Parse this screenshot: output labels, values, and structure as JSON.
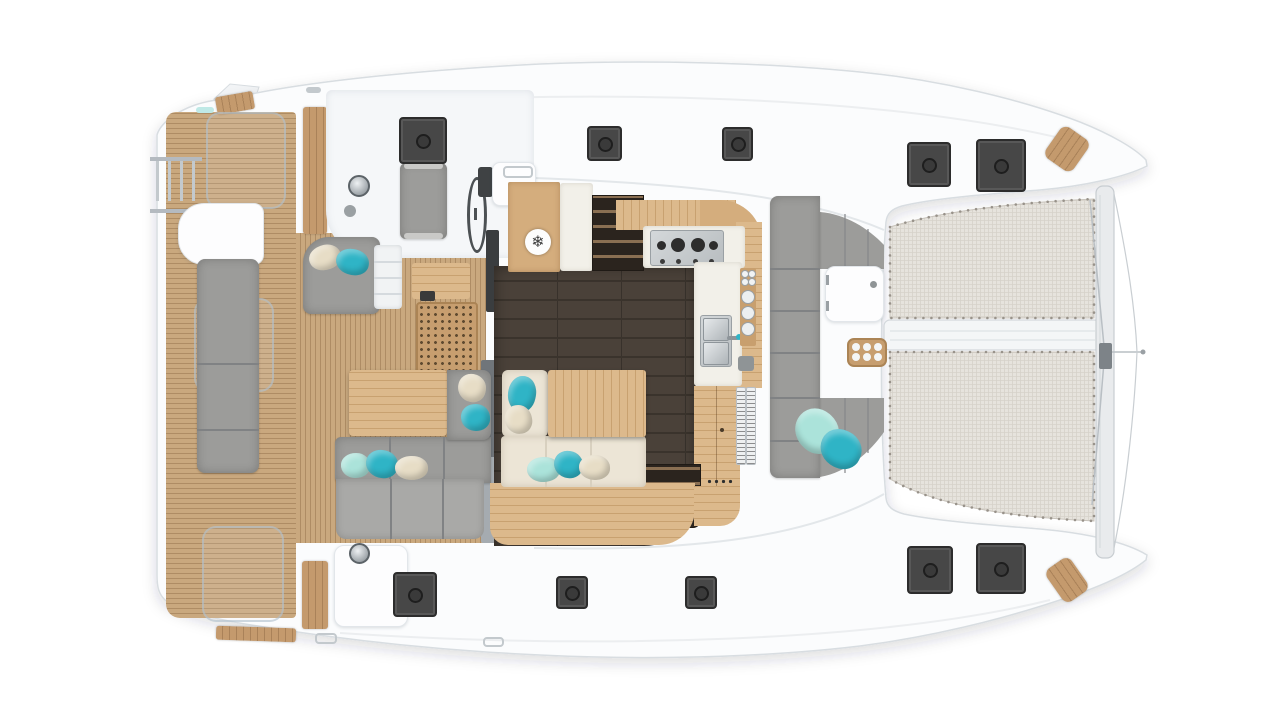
{
  "scene": {
    "subject": "Catamaran yacht deck floor plan, top-down 3D render",
    "view": "top-down",
    "background": "#ffffff"
  },
  "colors": {
    "page_bg": "#ffffff",
    "hull_white": "#fbfcfd",
    "deck_white": "#f5f7f9",
    "outline_gray": "#d8dde1",
    "teak": "#c9a87e",
    "teak_stripe": "#ae8c64",
    "plank_wood": "#c49a6d",
    "galley_wood": "#d4ad7d",
    "table_wood": "#dcb98c",
    "table_wood_line": "#c8a170",
    "saloon_floor": "#4a4139",
    "floor_line": "#3a332c",
    "counter_white": "#f2f0e9",
    "cushion_gray": "#9c9c9a",
    "cushion_gray_light": "#a9a9a7",
    "seam": "#808284",
    "cream_cushion": "#ece5d6",
    "pillow_teal": "#2fb4c6",
    "pillow_mint": "#abe3da",
    "pillow_cream": "#e7ddc6",
    "hatch": "#474747",
    "hatch_dark": "#2c2c2c",
    "hatch_mid": "#585858",
    "mesh": "#e6e3dd",
    "mesh_line": "#d6d2ca",
    "mesh_dot": "#98928a",
    "beam": "#e9ebed",
    "beam_border": "#c8cdd1",
    "grate": "#c79e6f",
    "grate_dot": "#5f4a30",
    "louver_white": "#eef0f1",
    "step_dark": "#2b241e",
    "step_wood": "#8a6f52"
  },
  "icons": {
    "snowflake": "❄"
  },
  "regions": [
    "swim platform and boarding ladder",
    "aft cockpit with sofa and table",
    "helm station with wheel",
    "saloon with galley and settee",
    "forward cockpit lounge",
    "twin trampolines",
    "bow crossbeam"
  ],
  "equipment": {
    "deck_hatches_total": 10,
    "trampoline_panels": 2,
    "helm_wheel": 1,
    "boarding_ladder": 1,
    "cooktop_burners": 4,
    "sink_basins": 2,
    "cupholders": 6,
    "fridge_freezer": 1,
    "companionway_steps": 2
  },
  "soft_goods": {
    "cushion_color": "gray",
    "settee_color": "cream",
    "pillow_colors": [
      "teal",
      "mint",
      "cream"
    ]
  }
}
